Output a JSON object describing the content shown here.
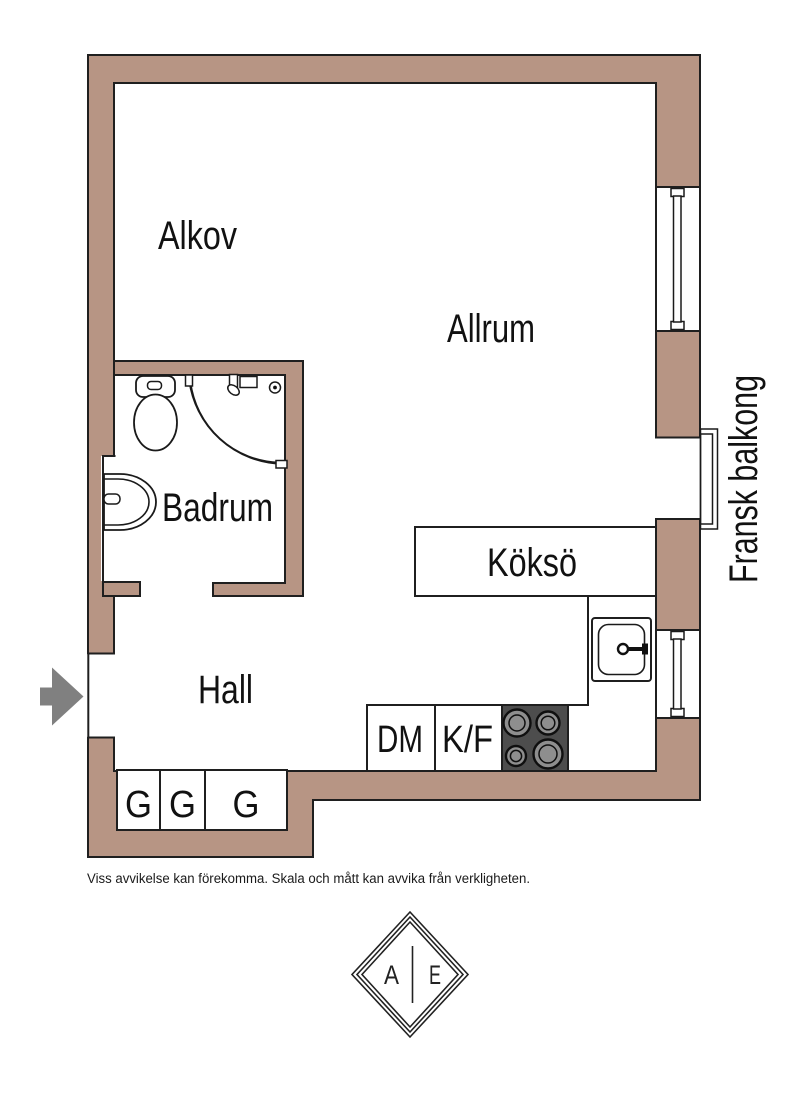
{
  "colors": {
    "wall": "#b79584",
    "outline": "#1f1f1f",
    "stove_body": "#4d4d4d",
    "burner_gray": "#8e8e8e",
    "arrow_gray": "#808080",
    "background": "#ffffff"
  },
  "rooms": {
    "alkov": "Alkov",
    "allrum": "Allrum",
    "badrum": "Badrum",
    "hall": "Hall",
    "kokso": "Köksö"
  },
  "kitchen": {
    "dishwasher": "DM",
    "fridge_freezer": "K/F"
  },
  "hallway": {
    "wardrobes": [
      "G",
      "G",
      "G"
    ]
  },
  "balcony": {
    "label": "Fransk balkong"
  },
  "footer": {
    "disclaimer": "Viss avvikelse kan förekomma. Skala och mått kan avvika från verkligheten."
  },
  "logo": {
    "left_letter": "A",
    "right_letter": "E"
  }
}
